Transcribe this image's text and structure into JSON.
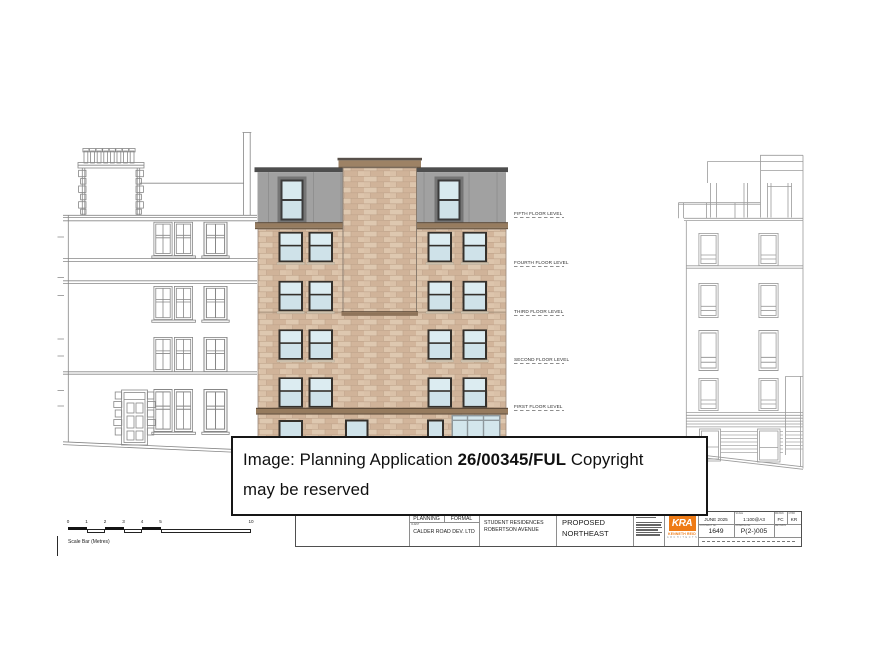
{
  "overlay": {
    "line1_prefix": "Image: Planning Application ",
    "reference": "26/00345/FUL",
    "line1_suffix": " Copyright",
    "line2": "may be reserved"
  },
  "floor_labels": [
    "FIFTH FLOOR LEVEL",
    "FOURTH FLOOR LEVEL",
    "THIRD FLOOR LEVEL",
    "SECOND FLOOR LEVEL",
    "FIRST FLOOR LEVEL"
  ],
  "scale_bar": {
    "ticks": [
      "0",
      "1",
      "2",
      "3",
      "4",
      "5",
      "10"
    ],
    "label": "Scale Bar (Metres)"
  },
  "title_block": {
    "revision_table": {
      "rev": "REV",
      "description": "DESCRIPTION",
      "date": "DATE",
      "drawn": "DRAWN",
      "chkd": "CHKD"
    },
    "stage": {
      "label": "STAGE",
      "value": "PLANNING"
    },
    "status": {
      "label": "STATUS",
      "value": "FORMAL"
    },
    "client": {
      "label": "CLIENT",
      "value": "CALDER ROAD DEV. LTD"
    },
    "project": {
      "label": "PROJECT",
      "line1": "STUDENT RESIDENCES",
      "line2": "ROBERTSON AVENUE"
    },
    "drawing_title": {
      "label": "DRAWING TITLE",
      "line1": "PROPOSED",
      "line2": "NORTHEAST"
    },
    "firm": {
      "logo_text": "KRA",
      "name": "KENNETH REID",
      "subtitle": "ARCHITECTS",
      "accent_color": "#ee7b16"
    },
    "date": {
      "label": "DATE",
      "value": "JUNE 2025"
    },
    "scale": {
      "label": "SCALE",
      "value": "1:100@A3"
    },
    "drawn": {
      "label": "DRAWN",
      "value": "FC"
    },
    "checked": {
      "label": "CHKD",
      "value": "KR"
    },
    "contract": {
      "label": "CONTRACT No.",
      "value": "1649"
    },
    "drawing_no": {
      "label": "DRAWING No.",
      "value": "P(2-)005"
    },
    "revision": {
      "label": "REVISION",
      "value": ""
    }
  }
}
